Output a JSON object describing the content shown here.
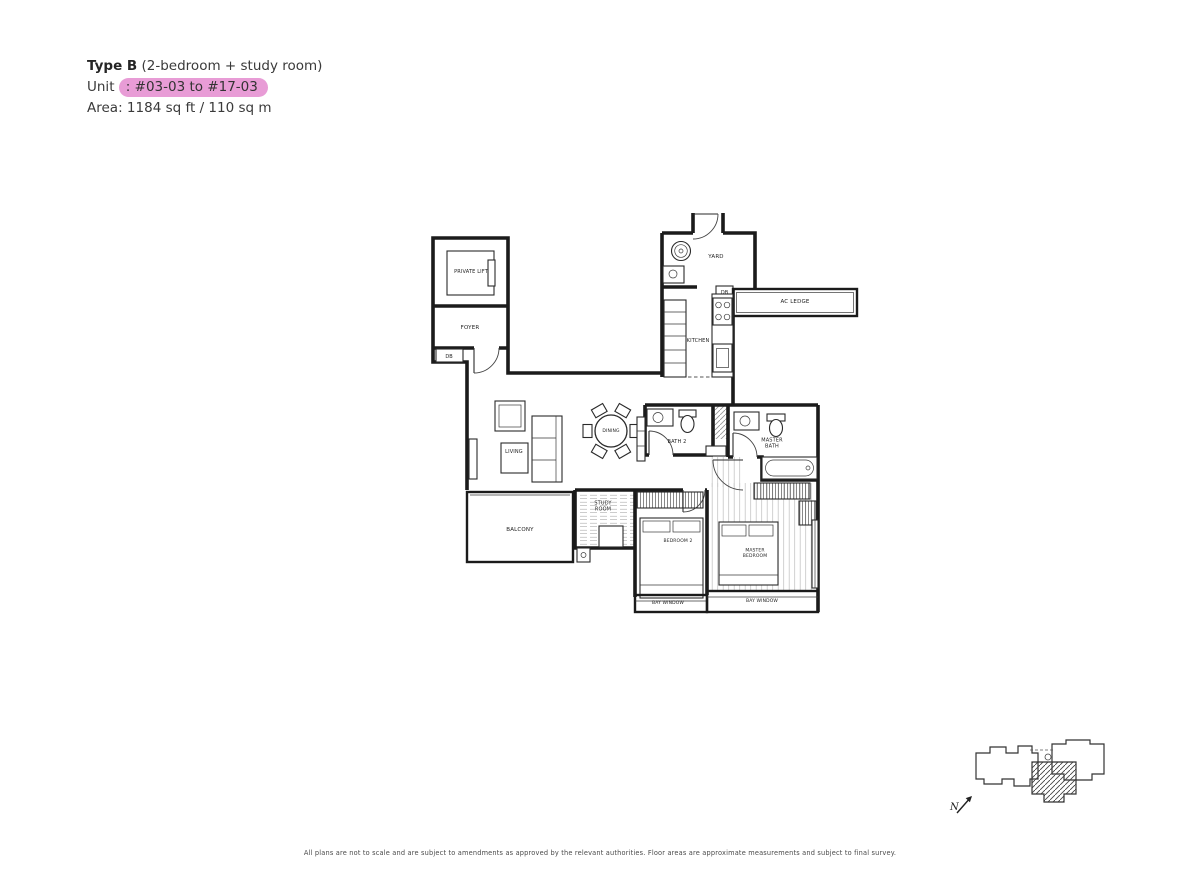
{
  "header": {
    "type_bold": "Type B",
    "type_rest": " (2-bedroom + study room)",
    "unit_label": "Unit ",
    "unit_separator": ":",
    "unit_value": "#03-03 to #17-03",
    "area_label": "Area:",
    "area_value": "1184 sq ft / 110 sq m",
    "highlight_color": "#e89cd6"
  },
  "plan": {
    "rooms": {
      "private_lift": "PRIVATE LIFT",
      "foyer": "FOYER",
      "yard": "YARD",
      "ac_ledge": "AC LEDGE",
      "kitchen": "KITCHEN",
      "dining": "DINING",
      "living": "LIVING",
      "bath2": "BATH 2",
      "master_bath": "MASTER BATH",
      "balcony": "BALCONY",
      "study_room": "STUDY ROOM",
      "bedroom2": "BEDROOM 2",
      "master_bedroom": "MASTER BEDROOM",
      "bay_window": "BAY WINDOW"
    },
    "fixtures": {
      "db": "DB"
    }
  },
  "key_plan": {
    "north_label": "N"
  },
  "footer": {
    "disclaimer": "All plans are not to scale and are subject to amendments as approved by the relevant authorities. Floor areas are approximate measurements and subject to final survey."
  }
}
